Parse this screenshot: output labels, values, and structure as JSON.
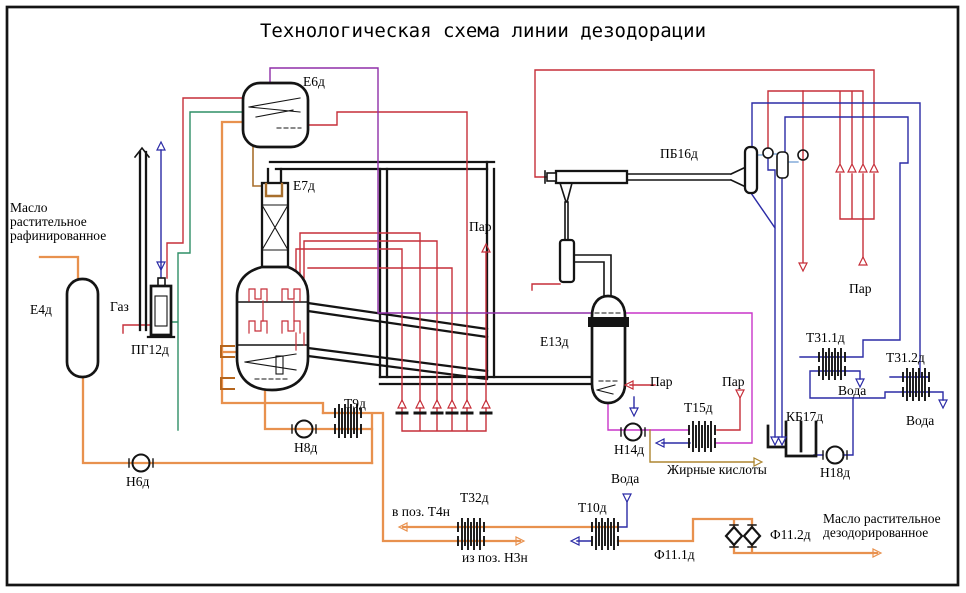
{
  "title": "Технологическая схема линии дезодорации",
  "colors": {
    "red": "#c62f39",
    "blue": "#2b2ba6",
    "light_blue": "#6b9bd2",
    "orange": "#e8914e",
    "purple": "#8f2fa8",
    "magenta": "#c935c9",
    "green": "#2f8f66",
    "olive": "#ad8630",
    "brown": "#a86f2d"
  },
  "labels": {
    "par": "Пар",
    "voda": "Вода",
    "gas": "Газ",
    "e4d": "Е4д",
    "pg12d": "ПГ12д",
    "e6d": "Е6д",
    "e7d": "Е7д",
    "pb16d": "ПБ16д",
    "e13d": "Е13д",
    "t9d": "Т9д",
    "n8d": "Н8д",
    "n6d": "Н6д",
    "n14d": "Н14д",
    "t15d": "Т15д",
    "t32d": "Т32д",
    "t10d": "Т10д",
    "t31_1d": "Т31.1д",
    "t31_2d": "Т31.2д",
    "kb17d": "КБ17д",
    "n18d": "Н18д",
    "f11_1d": "Ф11.1д",
    "f11_2d": "Ф11.2д",
    "zhirnye_kisloty": "Жирные кислоты",
    "v_poz_t4n": "в поз. Т4н",
    "iz_poz_n3n": "из поз. Н3н"
  },
  "streams": {
    "oil_in_lines": [
      "Масло",
      "растительное",
      "рафинированное"
    ],
    "oil_out_lines": [
      "Масло растительное",
      "дезодорированное"
    ]
  }
}
